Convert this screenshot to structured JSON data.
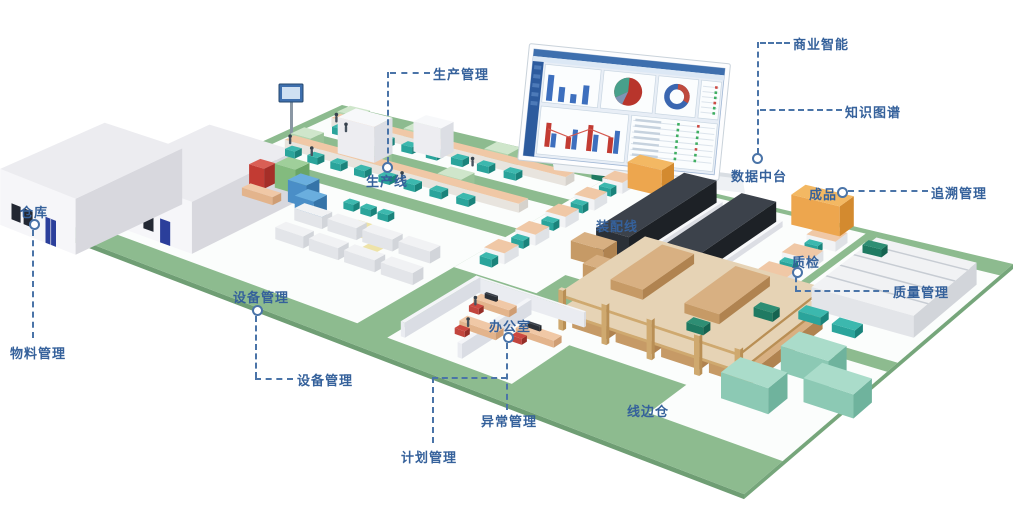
{
  "callouts": {
    "production_mgmt": "生产管理",
    "production_line": "生产线",
    "business_intelligence": "商业智能",
    "knowledge_graph": "知识图谱",
    "data_platform": "数据中台",
    "finished_goods": "成品",
    "trace_mgmt": "追溯管理",
    "warehouse": "仓库",
    "material_mgmt": "物料管理",
    "equipment_mgmt_a": "设备管理",
    "equipment_mgmt_b": "设备管理",
    "office": "办公室",
    "exception_mgmt": "异常管理",
    "plan_mgmt": "计划管理",
    "assembly_line": "装配线",
    "lineside_warehouse": "线边仓",
    "quality_check": "质检",
    "quality_mgmt": "质量管理"
  },
  "scene": {
    "dashboard_panels": [
      "bar-chart",
      "pie-chart",
      "donut-chart",
      "status-table",
      "grouped-bar-chart",
      "status-table"
    ]
  },
  "colors": {
    "label_text": "#35619b",
    "leader_line": "#4a74a8",
    "floor_green": "#8dbb8f",
    "floor_edge": "#76a67b",
    "pad_white": "#fbfdfc",
    "conveyor_tan": "#f0c8a6",
    "machine_teal": "#2aa49b",
    "machine_dark": "#2b3037",
    "finished_goods_orange": "#eda64e",
    "carton_brown": "#c69a66",
    "rack_wood": "#cfa96f",
    "cube_mint": "#8cc9b4",
    "building_white": "#f6f6f9",
    "door_blue": "#2b3f9b",
    "dashboard_blue": "#3e6fae",
    "chair_red": "#c2453e"
  }
}
